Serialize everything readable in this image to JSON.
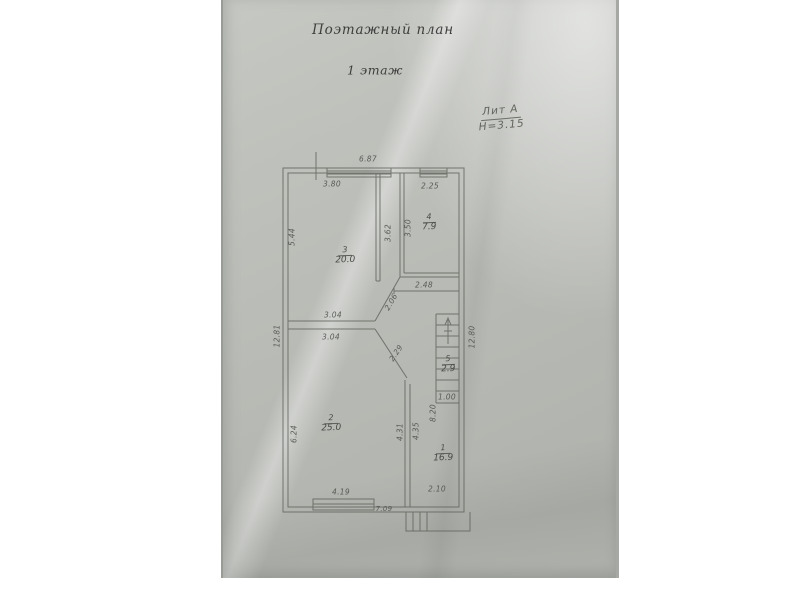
{
  "page": {
    "title": "Поэтажный план",
    "subtitle": "1 этаж",
    "litera": "Лит А",
    "height_note": "Н=3.15"
  },
  "rooms": [
    {
      "number": "1",
      "area": "16.9"
    },
    {
      "number": "2",
      "area": "25.0"
    },
    {
      "number": "3",
      "area": "20.0"
    },
    {
      "number": "4",
      "area": "7.9"
    },
    {
      "number": "5",
      "area": "2.9"
    }
  ],
  "dimensions": {
    "top_total": "6.87",
    "room3_top": "3.80",
    "room4_top": "2.25",
    "room3_left": "5.44",
    "left_total": "12.81",
    "room3_right": "3.62",
    "room4_left": "3.50",
    "hall_width": "2.48",
    "wall_upper": "3.04",
    "wall_lower": "3.04",
    "diag_upper": "2.06",
    "diag_lower": "2.29",
    "right_total": "12.80",
    "room2_left": "6.24",
    "room2_right": "4.31",
    "room1_left": "4.35",
    "room1_right": "8.20",
    "stair_width": "1.00",
    "room2_bottom": "4.19",
    "room1_bottom": "2.10",
    "bottom_total": "7.09"
  },
  "colors": {
    "paper": "#b9bbb6",
    "ink": "#3e3f3d",
    "pencil": "#4f544d",
    "plan_line": "#63675f"
  }
}
